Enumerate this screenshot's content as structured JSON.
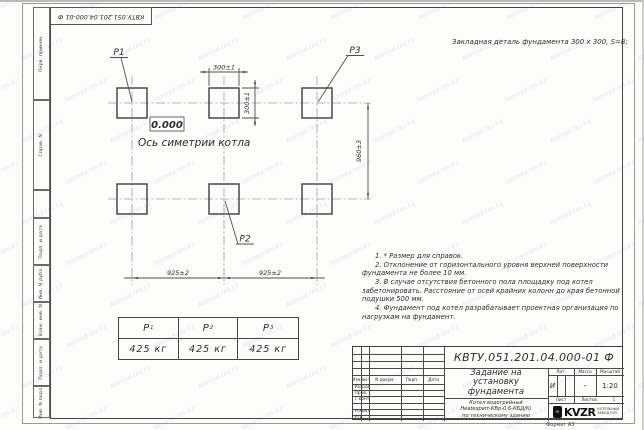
{
  "watermark": {
    "text": "Nomad-tev.kz"
  },
  "margin_labels": [
    "Перв. примен.",
    "Справ. N",
    "Подп. и дата",
    "Инв. N дубл.",
    "Взам. инв. N",
    "Подп. и дата",
    "Инв. N подл."
  ],
  "header_note": "Закладная деталь фундамента  300 х 300,  S=8;",
  "drawing": {
    "labels": {
      "p1": "P1",
      "p2": "P2",
      "p3": "P3"
    },
    "level": "0.000",
    "axis": "Ось симетрии котла",
    "dim_300_h": "300±1",
    "dim_300_v": "300±1",
    "dim_960": "960±3",
    "dim_925_left": "925±2",
    "dim_925_right": "925±2"
  },
  "load_table": {
    "columns": [
      {
        "p": "P",
        "sub": "1",
        "load": "425 кг"
      },
      {
        "p": "P",
        "sub": "2",
        "load": "425 кг"
      },
      {
        "p": "P",
        "sub": "3",
        "load": "425 кг"
      }
    ]
  },
  "notes": [
    "1. * Размер для справок.",
    "2. Отклонение от горизонтального уровня верхней поверхности фундамента не более 10 мм.",
    "3. В случае отсутствия бетонного пола площадку под котел забетонировать. Расстояние от осей крайних колонн до края бетонной подушки 500 мм.",
    "4. Фундамент под котел разрабатывает проектная организация по нагрузкам на фундамент."
  ],
  "title_block": {
    "doc_number": "КВТУ.051.201.04.000-01  Ф",
    "title_lines": [
      "Задание на",
      "установку",
      "фундамента"
    ],
    "object_lines": [
      "Котел водогрейный",
      "Heatexpert-КВр-0,6-КБД(К)",
      "по техническому зданию"
    ],
    "change_header": {
      "izm": "Изм.",
      "list": "Лист",
      "n_dokum": "N докум.",
      "podp": "Подп.",
      "data": "Дата"
    },
    "sign_rows": [
      "Разраб.",
      "Пров.",
      "Т.контр.",
      "",
      "Н.контр.",
      "Утв."
    ],
    "lit_header": "Лит.",
    "lit_value": "И",
    "massa_header": "Масса",
    "massa_value": "-",
    "masshtab_header": "Масштаб",
    "masshtab_value": "1:20",
    "sheet": {
      "list_label": "Лист",
      "listov_label": "Листов",
      "listov_value": "1"
    },
    "logo": {
      "mark": "≈",
      "name": "KVZR",
      "caption1": "КОТЕЛЬНЫЙ",
      "caption2": "ЗАВОД РЭП"
    }
  },
  "format_note": "Формат А3"
}
